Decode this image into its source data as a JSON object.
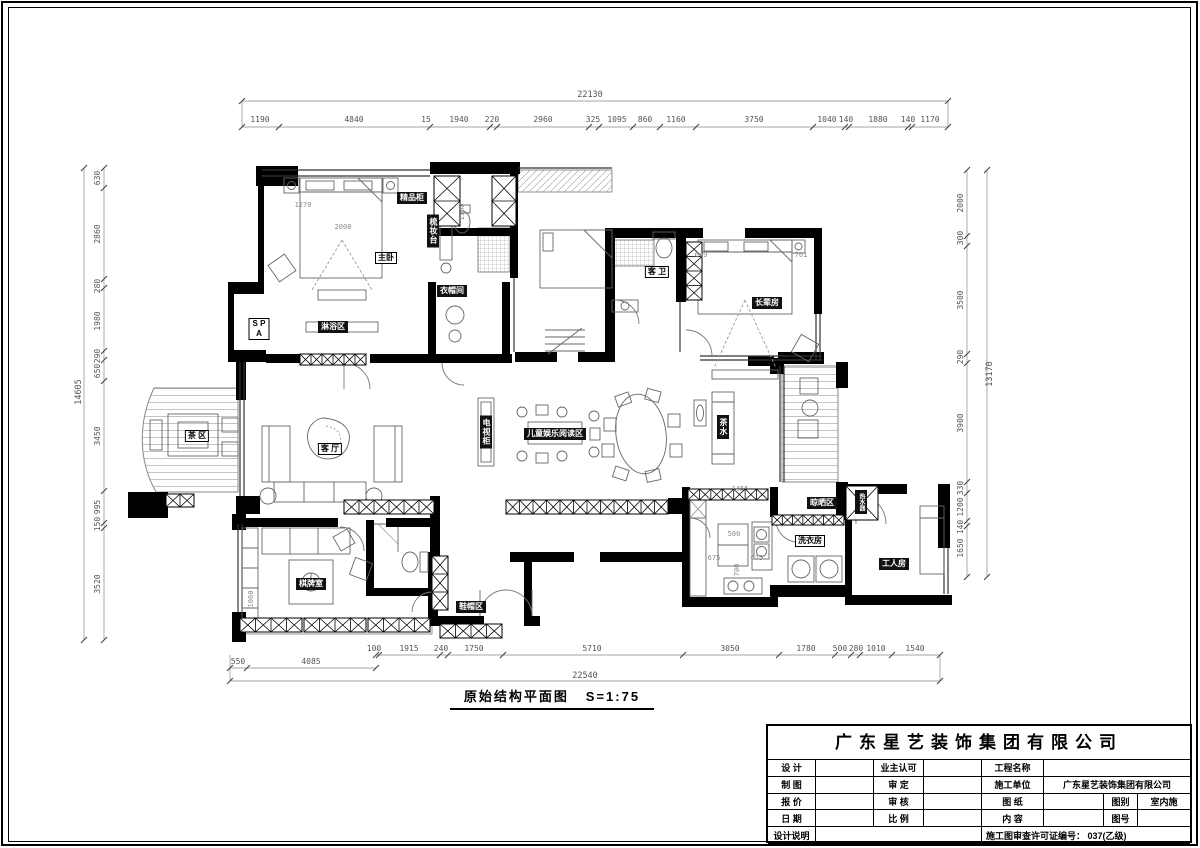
{
  "caption": {
    "title": "原始结构平面图",
    "scale": "S=1:75"
  },
  "dimensions": {
    "top": {
      "total": "22130",
      "segments": [
        "1190",
        "4840",
        "15",
        "1940",
        "220",
        "2960",
        "325",
        "1095",
        "860",
        "1160",
        "3750",
        "1040",
        "140",
        "1880",
        "140",
        "1170"
      ]
    },
    "bottom": {
      "total": "22540",
      "segments": [
        "100",
        "1915",
        "240",
        "1750",
        "5710",
        "3050",
        "1780",
        "500",
        "280",
        "1010",
        "1540"
      ],
      "sub_segments": [
        "550",
        "4085"
      ]
    },
    "left": {
      "total": "14605",
      "segments": [
        "630",
        "2860",
        "280",
        "1980",
        "290",
        "650",
        "3450",
        "995",
        "150",
        "3520"
      ]
    },
    "right": {
      "total": "13170",
      "segments": [
        "2000",
        "300",
        "3500",
        "290",
        "3900",
        "330",
        "1200",
        "140",
        "1650"
      ]
    }
  },
  "plan_dims": {
    "d1270": "1270",
    "d2000": "2000",
    "d1100": "1100",
    "d649": "649",
    "d701": "701",
    "d1455": "1455",
    "d500": "500",
    "d675a": "675",
    "d675b": "675",
    "d700": "700",
    "d1060": "1060"
  },
  "room_labels": {
    "master_bedroom": "主卧",
    "boutique_cabinet": "精品柜",
    "dressing_table": "梳妆台",
    "cloakroom": "衣帽间",
    "shower_area": "淋浴区",
    "spa": "S P A",
    "guest_bath": "客 卫",
    "elder_room": "长辈房",
    "tea_area": "茶 区",
    "living_room": "客 厅",
    "tv_cabinet": "电视柜",
    "children_area": "儿童娱乐阅读区",
    "tea_cabinet": "茶水",
    "drying_area": "晾晒区",
    "laundry": "洗衣房",
    "worker_room": "工人房",
    "water_heater": "热水器",
    "chess_room": "棋牌室",
    "shoe_area": "鞋帽区"
  },
  "title_block": {
    "company": "广东星艺装饰集团有限公司",
    "labels": {
      "design": "设 计",
      "owner_ok": "业主认可",
      "project": "工程名称",
      "draft": "制 图",
      "approve": "审 定",
      "contractor": "施工单位",
      "quote": "报 价",
      "check": "审 核",
      "drawing": "图 纸",
      "category": "图别",
      "date": "日 期",
      "scale": "比 例",
      "content": "内 容",
      "number": "图号",
      "notes": "设计说明"
    },
    "values": {
      "contractor_value": "广东星艺装饰集团有限公司",
      "category_value": "室内施",
      "license": "施工图审查许可证编号：  037(乙级)"
    }
  }
}
